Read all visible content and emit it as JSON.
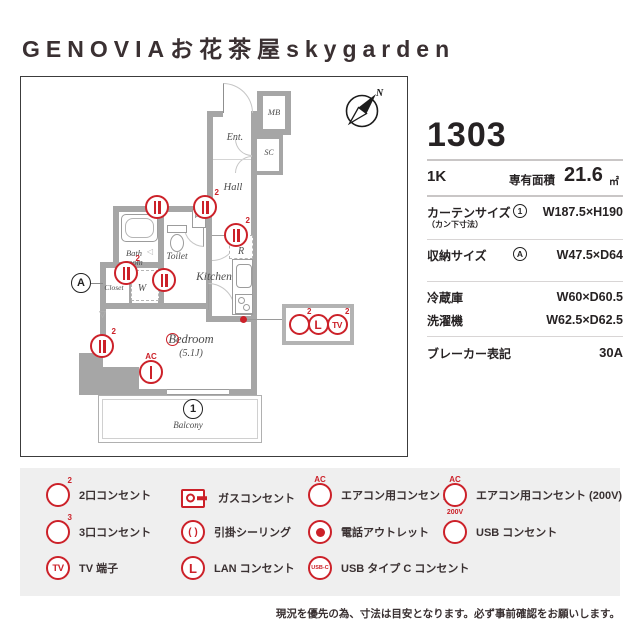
{
  "title": "GENOVIAお花茶屋skygarden",
  "unit": {
    "number": "1303",
    "type": "1K",
    "area_label": "専有面積",
    "area_value": "21.6",
    "area_unit": "㎡"
  },
  "specs": {
    "curtain": {
      "label": "カーテンサイズ",
      "sublabel": "（カン下寸法）",
      "marker": "1",
      "value": "W187.5×H190"
    },
    "storage": {
      "label": "収納サイズ",
      "marker": "A",
      "value": "W47.5×D64"
    },
    "fridge": {
      "label": "冷蔵庫",
      "value": "W60×D60.5"
    },
    "washer": {
      "label": "洗濯機",
      "value": "W62.5×D62.5"
    },
    "breaker": {
      "label": "ブレーカー表記",
      "value": "30A"
    }
  },
  "floorplan": {
    "labels": {
      "mb": "MB",
      "ent": "Ent.",
      "sc": "SC",
      "hall": "Hall",
      "ps": "PS",
      "bath_line1": "Bath",
      "bath_line2": "room",
      "toilet": "Toilet",
      "kitchen": "Kitchen",
      "fridge": "R",
      "closet": "Closet",
      "washer": "W",
      "bedroom": "Bedroom",
      "bedroom_size": "(5.1J)",
      "balcony": "Balcony",
      "compass": "N",
      "marker_a": "A",
      "marker_1": "1"
    },
    "glyphs": {
      "fold": "◁",
      "vent": "▽"
    }
  },
  "icons": {
    "sup_2": "2",
    "sup_3": "3",
    "sup_ac": "AC",
    "sub_200v": "200V",
    "tv": "TV",
    "lan": "L",
    "usb": "USB",
    "usbc": "USB-C",
    "ceiling": "( )"
  },
  "legend": {
    "items": [
      {
        "label": "2口コンセント"
      },
      {
        "label": "3口コンセント"
      },
      {
        "label": "TV 端子"
      },
      {
        "label": "ガスコンセント"
      },
      {
        "label": "引掛シーリング"
      },
      {
        "label": "LAN コンセント"
      },
      {
        "label": "エアコン用コンセント"
      },
      {
        "label": "電話アウトレット"
      },
      {
        "label": "USB タイプ C コンセント"
      },
      {
        "label": "エアコン用コンセント (200V)"
      },
      {
        "label": "USB コンセント"
      }
    ]
  },
  "note": "現況を優先の為、寸法は目安となります。必ず事前確認をお願いします。",
  "colors": {
    "accent_red": "#cc2129",
    "wall_gray": "#a6a6a6",
    "text_dark": "#3a3132",
    "legend_bg": "#efefef"
  }
}
